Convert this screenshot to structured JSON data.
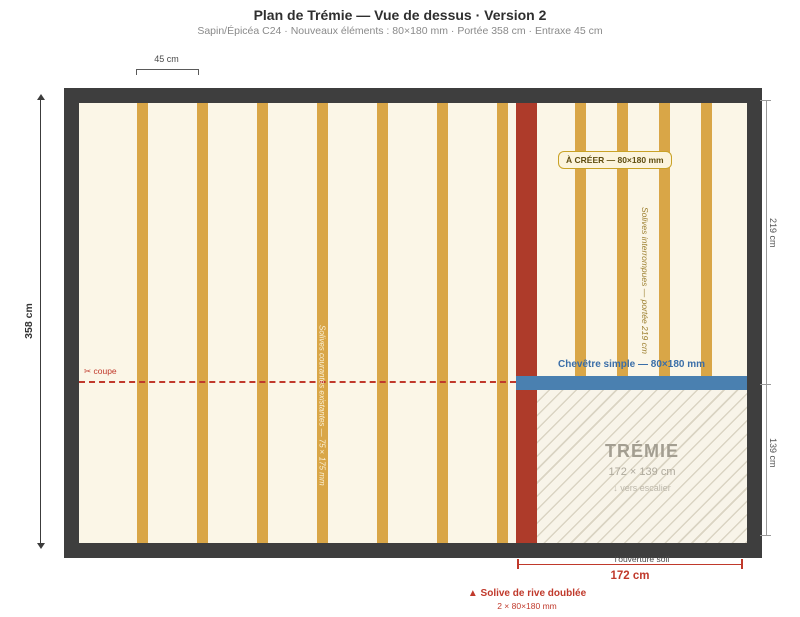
{
  "header": {
    "title": "Plan de Trémie — Vue de dessus · Version 2",
    "subtitle": "Sapin/Épicéa C24 · Nouveaux éléments : 80×180 mm · Portée 358 cm · Entraxe 45 cm"
  },
  "dimensions": {
    "entraxe": "45 cm",
    "span_left": "358 cm",
    "right_top": "219 cm",
    "right_bottom": "139 cm",
    "opening_width": "172 cm"
  },
  "plan": {
    "coupe_label": "✂ coupe",
    "a_creer_label": "À CRÉER — 80×180 mm",
    "solives_interrompues_label": "Solives interrompues — portée 219 cm",
    "solives_courantes_label": "Solives courantes existantes — 75×175 mm",
    "chevetre_label": "Chevêtre simple — 80×180 mm",
    "tremie": {
      "title": "TRÉMIE",
      "size": "172 × 139 cm",
      "direction": "↓ vers escalier"
    },
    "ouverture_label": "l'ouverture soll",
    "rive_title": "▲ Solive de rive doublée",
    "rive_sub": "2 × 80×180 mm"
  },
  "colors": {
    "wall": "#3E3E3E",
    "floor": "#FBF6E7",
    "joist": "#D9A647",
    "new_rim_red": "#AE3B2A",
    "chevetre_blue": "#4A80B0",
    "accent_red": "#C0392B",
    "olive_label": "#9C7F2F",
    "tremie_gray": "#A39E91",
    "chip_border": "#C9A227"
  }
}
